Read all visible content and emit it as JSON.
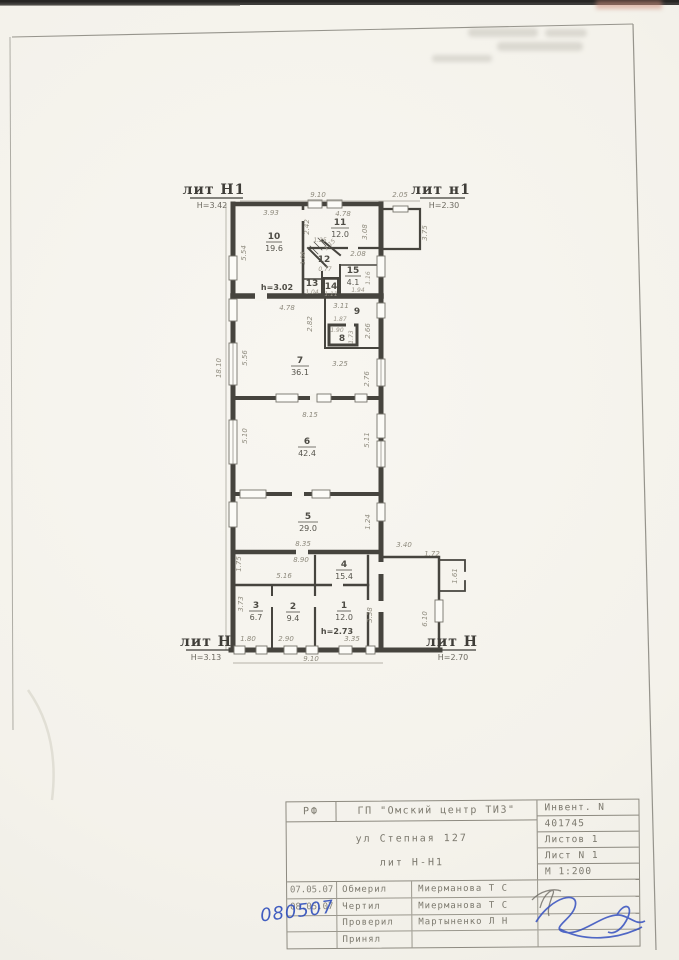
{
  "plan": {
    "labels": {
      "lit_top_left": "лит Н1",
      "lit_top_left_h": "Н=3.42",
      "lit_top_right": "лит н1",
      "lit_top_right_h": "Н=2.30",
      "lit_bottom_left": "лит Н",
      "lit_bottom_left_h": "Н=3.13",
      "lit_bottom_right": "лит Н",
      "lit_bottom_right_h": "Н=2.70"
    },
    "heights": {
      "upper": "h=3.02",
      "lower": "h=2.73"
    },
    "rooms": [
      {
        "num": "10",
        "area": "19.6"
      },
      {
        "num": "11",
        "area": "12.0"
      },
      {
        "num": "12",
        "area": ""
      },
      {
        "num": "13",
        "area": ""
      },
      {
        "num": "14",
        "area": ""
      },
      {
        "num": "15",
        "area": "4.1"
      },
      {
        "num": "9",
        "area": ""
      },
      {
        "num": "8",
        "area": ""
      },
      {
        "num": "7",
        "area": "36.1"
      },
      {
        "num": "6",
        "area": "42.4"
      },
      {
        "num": "5",
        "area": "29.0"
      },
      {
        "num": "4",
        "area": "15.4"
      },
      {
        "num": "3",
        "area": "6.7"
      },
      {
        "num": "2",
        "area": "9.4"
      },
      {
        "num": "1",
        "area": "12.0"
      }
    ],
    "dims": [
      "9.10",
      "2.05",
      "3.93",
      "2.42",
      "4.78",
      "5.54",
      "1.25",
      "2.08",
      "3.08",
      "3.75",
      "1.16",
      "1.94",
      "1.04",
      "1.11",
      "4.78",
      "3.11",
      "2.82",
      "1.87",
      "1.90",
      "2.66",
      "1.73",
      "5.56",
      "3.25",
      "2.76",
      "18.10",
      "8.15",
      "5.10",
      "5.11",
      "8.35",
      "8.90",
      "1.24",
      "3.40",
      "1.72",
      "1.61",
      "1.75",
      "5.16",
      "3.73",
      "3.38",
      "6.10",
      "1.80",
      "2.90",
      "3.35",
      "9.10",
      "1.15",
      "1.08",
      "0.77"
    ]
  },
  "title_block": {
    "org_small": "РФ",
    "org": "ГП \"Омский центр ТИЗ\"",
    "address": "ул Степная 127",
    "liter": "лит Н-Н1",
    "inventory_label": "Инвент. N",
    "inventory_number": "401745",
    "sheets_total": "Листов 1",
    "sheet_number": "Лист N 1",
    "scale": "М 1:200",
    "rows": [
      {
        "date": "07.05.07",
        "role": "Обмерил",
        "name": "Миерманова Т С"
      },
      {
        "date": "08.05.07",
        "role": "Чертил",
        "name": "Миерманова Т С"
      },
      {
        "date": "",
        "role": "Проверил",
        "name": "Мартыненко Л Н"
      },
      {
        "date": "",
        "role": "Принял",
        "name": ""
      }
    ],
    "handwritten_date": "080507"
  }
}
